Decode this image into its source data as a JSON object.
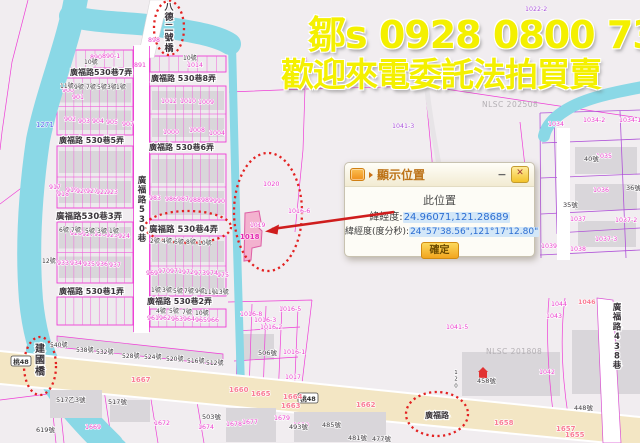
{
  "ad": {
    "line1": "鄒s 0928 0800 73",
    "line2": "歡迎來電委託法拍買賣"
  },
  "dialog": {
    "title": "顯示位置",
    "minimize_label": "−",
    "close_label": "✕",
    "location_heading": "此位置",
    "latlng_label": "緯經度:",
    "latlng_value": "24.96071,121.28689",
    "dms_label": "緯經度(度分秒):",
    "dms_value": "24°57'38.56\",121°17'12.80\"",
    "confirm_label": "確定"
  },
  "colors": {
    "ad_text": "#f4f000",
    "parcel_line": "#ee3ed6",
    "purple_line": "#b052d8",
    "river": "#8ad8e6",
    "road_major": "#f3e6c4",
    "highlight_ellipse": "#e32222",
    "target_parcel_fill": "#f3abcb",
    "value_highlight": "#d3e7f8",
    "value_text": "#2c6ed2",
    "button_yellow": "#f2a51f"
  },
  "map": {
    "labels": [
      {
        "t": "廣福路530巷7弄",
        "x": 70,
        "y": 75,
        "c": "st",
        "s": 8
      },
      {
        "t": "廣福路 530巷8弄",
        "x": 151,
        "y": 81,
        "c": "st",
        "s": 8
      },
      {
        "t": "廣福路 530巷5弄",
        "x": 59,
        "y": 143,
        "c": "st",
        "s": 8
      },
      {
        "t": "廣福路 530巷6弄",
        "x": 149,
        "y": 150,
        "c": "st",
        "s": 8
      },
      {
        "t": "廣福路530巷3弄",
        "x": 56,
        "y": 219,
        "c": "st",
        "s": 8.5
      },
      {
        "t": "廣福路 530巷4弄",
        "x": 149,
        "y": 232,
        "c": "st",
        "s": 8.5
      },
      {
        "t": "廣福路 530巷1弄",
        "x": 59,
        "y": 294,
        "c": "st",
        "s": 8
      },
      {
        "t": "廣福路 530巷2弄",
        "x": 147,
        "y": 304,
        "c": "st",
        "s": 8
      },
      {
        "t": "廣福路530巷",
        "x": 142,
        "y": 183,
        "c": "st",
        "s": 8.5,
        "v": 1
      },
      {
        "t": "廣福路438巷",
        "x": 617,
        "y": 310,
        "c": "st",
        "s": 8.5,
        "v": 1
      },
      {
        "t": "廣福路",
        "x": 425,
        "y": 418,
        "c": "st",
        "s": 8
      },
      {
        "t": "八德二號橋",
        "x": 169,
        "y": 10,
        "c": "st",
        "s": 9,
        "v": 1
      },
      {
        "t": "建國橋",
        "x": 40,
        "y": 352,
        "c": "st",
        "s": 10,
        "v": 1
      },
      {
        "t": "桃48",
        "x": 21,
        "y": 364,
        "c": "bdg",
        "s": 6.5
      },
      {
        "t": "桃48",
        "x": 308,
        "y": 401,
        "c": "bdg",
        "s": 6.5
      },
      {
        "t": "890",
        "x": 90,
        "y": 59,
        "c": "pn",
        "s": 6.3
      },
      {
        "t": "890-1",
        "x": 102,
        "y": 58,
        "c": "pn",
        "s": 6.3
      },
      {
        "t": "891",
        "x": 134,
        "y": 67,
        "c": "pn",
        "s": 6.3
      },
      {
        "t": "898",
        "x": 148,
        "y": 42,
        "c": "pn",
        "s": 6.3
      },
      {
        "t": "1014",
        "x": 187,
        "y": 67,
        "c": "pn",
        "s": 6.3
      },
      {
        "t": "900",
        "x": 62,
        "y": 92,
        "c": "pn",
        "s": 6.3
      },
      {
        "t": "901",
        "x": 72,
        "y": 99,
        "c": "pn",
        "s": 6.3
      },
      {
        "t": "902",
        "x": 64,
        "y": 121,
        "c": "pn",
        "s": 6.3
      },
      {
        "t": "903",
        "x": 78,
        "y": 123,
        "c": "pn",
        "s": 6.3
      },
      {
        "t": "904",
        "x": 92,
        "y": 123,
        "c": "pn",
        "s": 6.3
      },
      {
        "t": "905",
        "x": 106,
        "y": 124,
        "c": "pn",
        "s": 6.3
      },
      {
        "t": "907",
        "x": 122,
        "y": 126,
        "c": "pn",
        "s": 6.3
      },
      {
        "t": "1271",
        "x": 36,
        "y": 127,
        "c": "bl",
        "s": 7
      },
      {
        "t": "917",
        "x": 49,
        "y": 189,
        "c": "pn",
        "s": 6.3
      },
      {
        "t": "918",
        "x": 57,
        "y": 196,
        "c": "pn",
        "s": 6.3
      },
      {
        "t": "919",
        "x": 66,
        "y": 192,
        "c": "pn",
        "s": 6.3
      },
      {
        "t": "920",
        "x": 76,
        "y": 193,
        "c": "pn",
        "s": 6.3
      },
      {
        "t": "921",
        "x": 86,
        "y": 193,
        "c": "pn",
        "s": 6.3
      },
      {
        "t": "922",
        "x": 96,
        "y": 194,
        "c": "pn",
        "s": 6.3
      },
      {
        "t": "923",
        "x": 106,
        "y": 194,
        "c": "pn",
        "s": 6.3
      },
      {
        "t": "928",
        "x": 70,
        "y": 235,
        "c": "pn",
        "s": 6.3
      },
      {
        "t": "927",
        "x": 82,
        "y": 236,
        "c": "pn",
        "s": 6.3
      },
      {
        "t": "926",
        "x": 94,
        "y": 236,
        "c": "pn",
        "s": 6.3
      },
      {
        "t": "925",
        "x": 106,
        "y": 237,
        "c": "pn",
        "s": 6.3
      },
      {
        "t": "924",
        "x": 118,
        "y": 238,
        "c": "pn",
        "s": 6.3
      },
      {
        "t": "933",
        "x": 57,
        "y": 265,
        "c": "pn",
        "s": 6.3
      },
      {
        "t": "934",
        "x": 70,
        "y": 265,
        "c": "pn",
        "s": 6.3
      },
      {
        "t": "935",
        "x": 83,
        "y": 266,
        "c": "pn",
        "s": 6.3
      },
      {
        "t": "936",
        "x": 96,
        "y": 266,
        "c": "pn",
        "s": 6.3
      },
      {
        "t": "937",
        "x": 109,
        "y": 267,
        "c": "pn",
        "s": 6.3
      },
      {
        "t": "1012",
        "x": 161,
        "y": 103,
        "c": "pn",
        "s": 6.3
      },
      {
        "t": "1010",
        "x": 180,
        "y": 103,
        "c": "pn",
        "s": 6.3
      },
      {
        "t": "1009",
        "x": 198,
        "y": 104,
        "c": "pn",
        "s": 6.3
      },
      {
        "t": "1000",
        "x": 163,
        "y": 134,
        "c": "pn",
        "s": 6.3
      },
      {
        "t": "1008",
        "x": 189,
        "y": 132,
        "c": "pn",
        "s": 6.3
      },
      {
        "t": "1004",
        "x": 209,
        "y": 135,
        "c": "pn",
        "s": 6.3
      },
      {
        "t": "983",
        "x": 149,
        "y": 200,
        "c": "pn",
        "s": 6.3
      },
      {
        "t": "986",
        "x": 165,
        "y": 201,
        "c": "pn",
        "s": 6.3
      },
      {
        "t": "987",
        "x": 177,
        "y": 201,
        "c": "pn",
        "s": 6.3
      },
      {
        "t": "988",
        "x": 189,
        "y": 202,
        "c": "pn",
        "s": 6.3
      },
      {
        "t": "989",
        "x": 201,
        "y": 202,
        "c": "pn",
        "s": 6.3
      },
      {
        "t": "990",
        "x": 213,
        "y": 203,
        "c": "pn",
        "s": 6.3
      },
      {
        "t": "969",
        "x": 146,
        "y": 275,
        "c": "pn",
        "s": 6.3
      },
      {
        "t": "970",
        "x": 158,
        "y": 273,
        "c": "pn",
        "s": 6.3
      },
      {
        "t": "971",
        "x": 170,
        "y": 273,
        "c": "pn",
        "s": 6.3
      },
      {
        "t": "972",
        "x": 182,
        "y": 274,
        "c": "pn",
        "s": 6.3
      },
      {
        "t": "973",
        "x": 194,
        "y": 275,
        "c": "pn",
        "s": 6.3
      },
      {
        "t": "974",
        "x": 206,
        "y": 275,
        "c": "pn",
        "s": 6.3
      },
      {
        "t": "975",
        "x": 217,
        "y": 277,
        "c": "pn",
        "s": 6.3
      },
      {
        "t": "961",
        "x": 147,
        "y": 320,
        "c": "pn",
        "s": 6.3
      },
      {
        "t": "962",
        "x": 159,
        "y": 320,
        "c": "pn",
        "s": 6.3
      },
      {
        "t": "963",
        "x": 171,
        "y": 321,
        "c": "pn",
        "s": 6.3
      },
      {
        "t": "964",
        "x": 183,
        "y": 321,
        "c": "pn",
        "s": 6.3
      },
      {
        "t": "965",
        "x": 195,
        "y": 322,
        "c": "pn",
        "s": 6.3
      },
      {
        "t": "966",
        "x": 207,
        "y": 322,
        "c": "pn",
        "s": 6.3
      },
      {
        "t": "1020",
        "x": 263,
        "y": 186,
        "c": "pn",
        "s": 6.5
      },
      {
        "t": "1016-6",
        "x": 288,
        "y": 213,
        "c": "pn",
        "s": 6.3
      },
      {
        "t": "1019",
        "x": 250,
        "y": 227,
        "c": "pn",
        "s": 6
      },
      {
        "t": "1018",
        "x": 240,
        "y": 239,
        "c": "pnb",
        "s": 7
      },
      {
        "t": "1022-2",
        "x": 525,
        "y": 11,
        "c": "pu",
        "s": 6.3
      },
      {
        "t": "1041-3",
        "x": 392,
        "y": 128,
        "c": "pu",
        "s": 6.3
      },
      {
        "t": "1034",
        "x": 548,
        "y": 126,
        "c": "pn",
        "s": 6.3
      },
      {
        "t": "1034-2",
        "x": 583,
        "y": 122,
        "c": "pn",
        "s": 6.3
      },
      {
        "t": "1034-1",
        "x": 619,
        "y": 122,
        "c": "pn",
        "s": 6.3
      },
      {
        "t": "1035",
        "x": 596,
        "y": 158,
        "c": "pn",
        "s": 6.3
      },
      {
        "t": "1036",
        "x": 593,
        "y": 192,
        "c": "pn",
        "s": 6.3
      },
      {
        "t": "1037",
        "x": 570,
        "y": 221,
        "c": "pn",
        "s": 6.3
      },
      {
        "t": "1037-2",
        "x": 615,
        "y": 222,
        "c": "pn",
        "s": 6.3
      },
      {
        "t": "1037-3",
        "x": 595,
        "y": 241,
        "c": "pn",
        "s": 6.3
      },
      {
        "t": "1039",
        "x": 541,
        "y": 248,
        "c": "pn",
        "s": 6.3
      },
      {
        "t": "1038",
        "x": 570,
        "y": 251,
        "c": "pn",
        "s": 6.3
      },
      {
        "t": "1041-5",
        "x": 446,
        "y": 329,
        "c": "pn",
        "s": 6.3
      },
      {
        "t": "1044",
        "x": 551,
        "y": 306,
        "c": "pn",
        "s": 6.3
      },
      {
        "t": "1043",
        "x": 546,
        "y": 318,
        "c": "pn",
        "s": 6.3
      },
      {
        "t": "1046",
        "x": 578,
        "y": 304,
        "c": "rn",
        "s": 6.3
      },
      {
        "t": "1042",
        "x": 539,
        "y": 374,
        "c": "pn",
        "s": 6.3
      },
      {
        "t": "1016-8",
        "x": 240,
        "y": 316,
        "c": "pn",
        "s": 6.3
      },
      {
        "t": "1016-5",
        "x": 279,
        "y": 311,
        "c": "pn",
        "s": 6.3
      },
      {
        "t": "1016-3",
        "x": 254,
        "y": 322,
        "c": "pn",
        "s": 6.3
      },
      {
        "t": "1016-2",
        "x": 260,
        "y": 329,
        "c": "pn",
        "s": 6.3
      },
      {
        "t": "1016-1",
        "x": 283,
        "y": 354,
        "c": "pn",
        "s": 6.3
      },
      {
        "t": "1017",
        "x": 285,
        "y": 379,
        "c": "pn",
        "s": 6.3
      },
      {
        "t": "1678",
        "x": 226,
        "y": 426,
        "c": "pn",
        "s": 6.3
      },
      {
        "t": "1677",
        "x": 242,
        "y": 424,
        "c": "pn",
        "s": 6.3
      },
      {
        "t": "1679",
        "x": 274,
        "y": 420,
        "c": "pn",
        "s": 6.3
      },
      {
        "t": "1680",
        "x": 293,
        "y": 427,
        "c": "pn",
        "s": 6.3
      },
      {
        "t": "1672",
        "x": 154,
        "y": 425,
        "c": "pn",
        "s": 6.3
      },
      {
        "t": "1674",
        "x": 198,
        "y": 429,
        "c": "pn",
        "s": 6.3
      },
      {
        "t": "1669",
        "x": 85,
        "y": 429,
        "c": "pn",
        "s": 6.3
      },
      {
        "t": "1667",
        "x": 131,
        "y": 382,
        "c": "rn",
        "s": 7
      },
      {
        "t": "1660",
        "x": 229,
        "y": 392,
        "c": "rn",
        "s": 7
      },
      {
        "t": "1665",
        "x": 251,
        "y": 396,
        "c": "rn",
        "s": 7
      },
      {
        "t": "1664",
        "x": 283,
        "y": 399,
        "c": "rn",
        "s": 7
      },
      {
        "t": "1663",
        "x": 281,
        "y": 408,
        "c": "rn",
        "s": 7
      },
      {
        "t": "1662",
        "x": 356,
        "y": 407,
        "c": "rn",
        "s": 7
      },
      {
        "t": "1658",
        "x": 494,
        "y": 425,
        "c": "rn",
        "s": 7
      },
      {
        "t": "1657",
        "x": 556,
        "y": 431,
        "c": "rn",
        "s": 7
      },
      {
        "t": "1655",
        "x": 565,
        "y": 437,
        "c": "rn",
        "s": 7
      },
      {
        "t": "NLSC 202508",
        "x": 482,
        "y": 107,
        "c": "wm",
        "s": 7.5
      },
      {
        "t": "NLSC 201808",
        "x": 486,
        "y": 354,
        "c": "wm",
        "s": 7.5
      },
      {
        "t": "10號",
        "x": 84,
        "y": 64,
        "c": "hn",
        "s": 6
      },
      {
        "t": "10號",
        "x": 183,
        "y": 60,
        "c": "hn",
        "s": 6
      },
      {
        "t": "11號",
        "x": 60,
        "y": 88,
        "c": "hn",
        "s": 6
      },
      {
        "t": "9號",
        "x": 74,
        "y": 89,
        "c": "hn",
        "s": 6
      },
      {
        "t": "7號",
        "x": 86,
        "y": 89,
        "c": "hn",
        "s": 6
      },
      {
        "t": "5號",
        "x": 97,
        "y": 89,
        "c": "hn",
        "s": 6
      },
      {
        "t": "3號",
        "x": 107,
        "y": 89,
        "c": "hn",
        "s": 6
      },
      {
        "t": "1號",
        "x": 116,
        "y": 89,
        "c": "hn",
        "s": 6
      },
      {
        "t": "12號",
        "x": 42,
        "y": 263,
        "c": "hn",
        "s": 6
      },
      {
        "t": "6號",
        "x": 59,
        "y": 232,
        "c": "hn",
        "s": 6
      },
      {
        "t": "7號",
        "x": 71,
        "y": 232,
        "c": "hn",
        "s": 6
      },
      {
        "t": "5號",
        "x": 85,
        "y": 233,
        "c": "hn",
        "s": 6
      },
      {
        "t": "3號",
        "x": 97,
        "y": 233,
        "c": "hn",
        "s": 6
      },
      {
        "t": "1號",
        "x": 109,
        "y": 233,
        "c": "hn",
        "s": 6
      },
      {
        "t": "2號",
        "x": 150,
        "y": 243,
        "c": "hn",
        "s": 6
      },
      {
        "t": "4號",
        "x": 162,
        "y": 243,
        "c": "hn",
        "s": 6
      },
      {
        "t": "6號",
        "x": 174,
        "y": 244,
        "c": "hn",
        "s": 6
      },
      {
        "t": "8號",
        "x": 186,
        "y": 244,
        "c": "hn",
        "s": 6
      },
      {
        "t": "10號",
        "x": 198,
        "y": 245,
        "c": "hn",
        "s": 6
      },
      {
        "t": "1號",
        "x": 151,
        "y": 292,
        "c": "hn",
        "s": 6
      },
      {
        "t": "3號",
        "x": 162,
        "y": 292,
        "c": "hn",
        "s": 6
      },
      {
        "t": "5號",
        "x": 173,
        "y": 293,
        "c": "hn",
        "s": 6
      },
      {
        "t": "7號",
        "x": 184,
        "y": 293,
        "c": "hn",
        "s": 6
      },
      {
        "t": "9號",
        "x": 195,
        "y": 293,
        "c": "hn",
        "s": 6
      },
      {
        "t": "11號",
        "x": 204,
        "y": 294,
        "c": "hn",
        "s": 6
      },
      {
        "t": "13號",
        "x": 215,
        "y": 294,
        "c": "hn",
        "s": 6
      },
      {
        "t": "4號",
        "x": 156,
        "y": 313,
        "c": "hn",
        "s": 6
      },
      {
        "t": "5號",
        "x": 169,
        "y": 313,
        "c": "hn",
        "s": 6
      },
      {
        "t": "7號",
        "x": 182,
        "y": 314,
        "c": "hn",
        "s": 6
      },
      {
        "t": "10號",
        "x": 195,
        "y": 315,
        "c": "hn",
        "s": 6
      },
      {
        "t": "40號",
        "x": 584,
        "y": 161,
        "c": "hn",
        "s": 6.5
      },
      {
        "t": "36號",
        "x": 626,
        "y": 190,
        "c": "hn",
        "s": 6.5
      },
      {
        "t": "35號",
        "x": 563,
        "y": 207,
        "c": "hn",
        "s": 6.5
      },
      {
        "t": "448號",
        "x": 574,
        "y": 410,
        "c": "hn",
        "s": 6.5
      },
      {
        "t": "458號",
        "x": 477,
        "y": 383,
        "c": "hn",
        "s": 6.5
      },
      {
        "t": "506號",
        "x": 258,
        "y": 355,
        "c": "hn",
        "s": 6.5
      },
      {
        "t": "493號",
        "x": 289,
        "y": 429,
        "c": "hn",
        "s": 6.5
      },
      {
        "t": "485號",
        "x": 322,
        "y": 427,
        "c": "hn",
        "s": 6.5
      },
      {
        "t": "481號",
        "x": 348,
        "y": 440,
        "c": "hn",
        "s": 6.5
      },
      {
        "t": "477號",
        "x": 372,
        "y": 441,
        "c": "hn",
        "s": 6.5
      },
      {
        "t": "540號",
        "x": 50,
        "y": 347,
        "c": "hn",
        "s": 6
      },
      {
        "t": "538號",
        "x": 76,
        "y": 352,
        "c": "hn",
        "s": 6
      },
      {
        "t": "532號",
        "x": 96,
        "y": 354,
        "c": "hn",
        "s": 6
      },
      {
        "t": "528號",
        "x": 122,
        "y": 358,
        "c": "hn",
        "s": 6
      },
      {
        "t": "524號",
        "x": 144,
        "y": 359,
        "c": "hn",
        "s": 6
      },
      {
        "t": "520號",
        "x": 166,
        "y": 361,
        "c": "hn",
        "s": 6
      },
      {
        "t": "516號",
        "x": 187,
        "y": 363,
        "c": "hn",
        "s": 6
      },
      {
        "t": "512號",
        "x": 206,
        "y": 365,
        "c": "hn",
        "s": 6
      },
      {
        "t": "517乙3號",
        "x": 56,
        "y": 402,
        "c": "hn",
        "s": 6.5
      },
      {
        "t": "517號",
        "x": 108,
        "y": 404,
        "c": "hn",
        "s": 6.5
      },
      {
        "t": "619號",
        "x": 36,
        "y": 432,
        "c": "hn",
        "s": 6.5
      },
      {
        "t": "503號",
        "x": 202,
        "y": 419,
        "c": "hn",
        "s": 6.5
      },
      {
        "t": "120",
        "x": 456,
        "y": 374,
        "c": "hn",
        "s": 5.5,
        "v": 1
      }
    ]
  }
}
